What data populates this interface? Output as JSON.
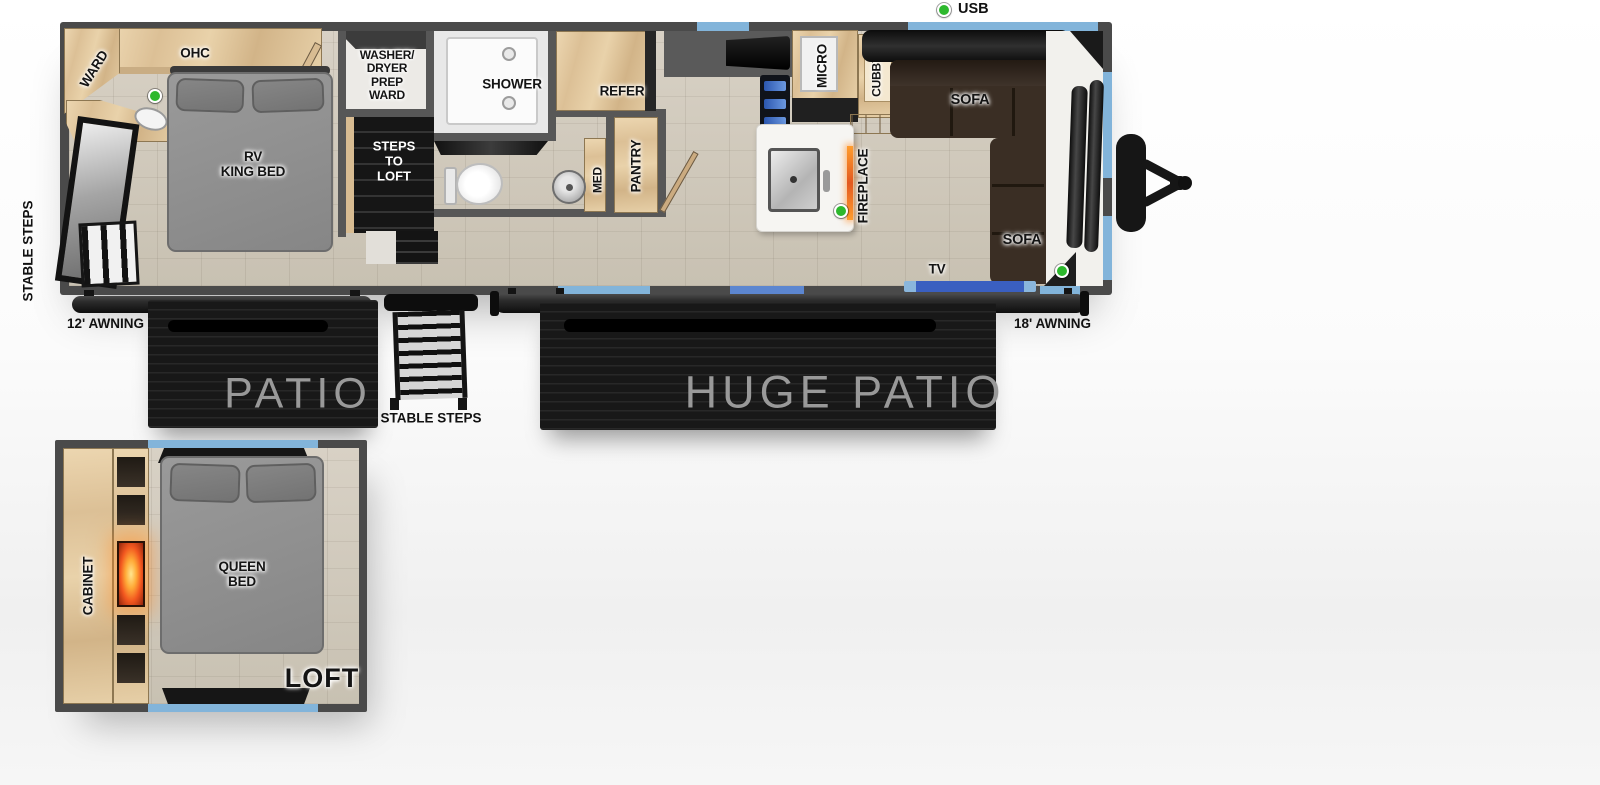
{
  "legend": {
    "usb": "USB"
  },
  "main_floor": {
    "ward": "WARD",
    "ohc": "OHC",
    "king_bed": "RV\nKING BED",
    "steps_to_loft": "STEPS\nTO\nLOFT",
    "washer_dryer": "WASHER/\nDRYER\nPREP\nWARD",
    "shower": "SHOWER",
    "med": "MED",
    "pantry": "PANTRY",
    "refer": "REFER",
    "micro": "MICRO",
    "cubby": "CUBBY",
    "fireplace": "FIREPLACE",
    "sofa_top": "SOFA",
    "sofa_right": "SOFA",
    "tv": "TV"
  },
  "exterior": {
    "stable_steps_side": "STABLE STEPS",
    "awning_left": "12' AWNING",
    "awning_right": "18' AWNING",
    "patio": "PATIO",
    "huge_patio": "HUGE PATIO",
    "stable_steps_center": "STABLE STEPS"
  },
  "loft": {
    "cabinet": "CABINET",
    "queen_bed": "QUEEN\nBED",
    "loft_label": "LOFT"
  },
  "colors": {
    "wall": "#4a4a4a",
    "window_blue": "#82b4da",
    "tv_blue": "#3a5fc0",
    "usb_green": "#2db82d",
    "wood": "#ddc094",
    "sofa_brown": "#3a2e24",
    "fire_orange": "#ff8c1a"
  }
}
